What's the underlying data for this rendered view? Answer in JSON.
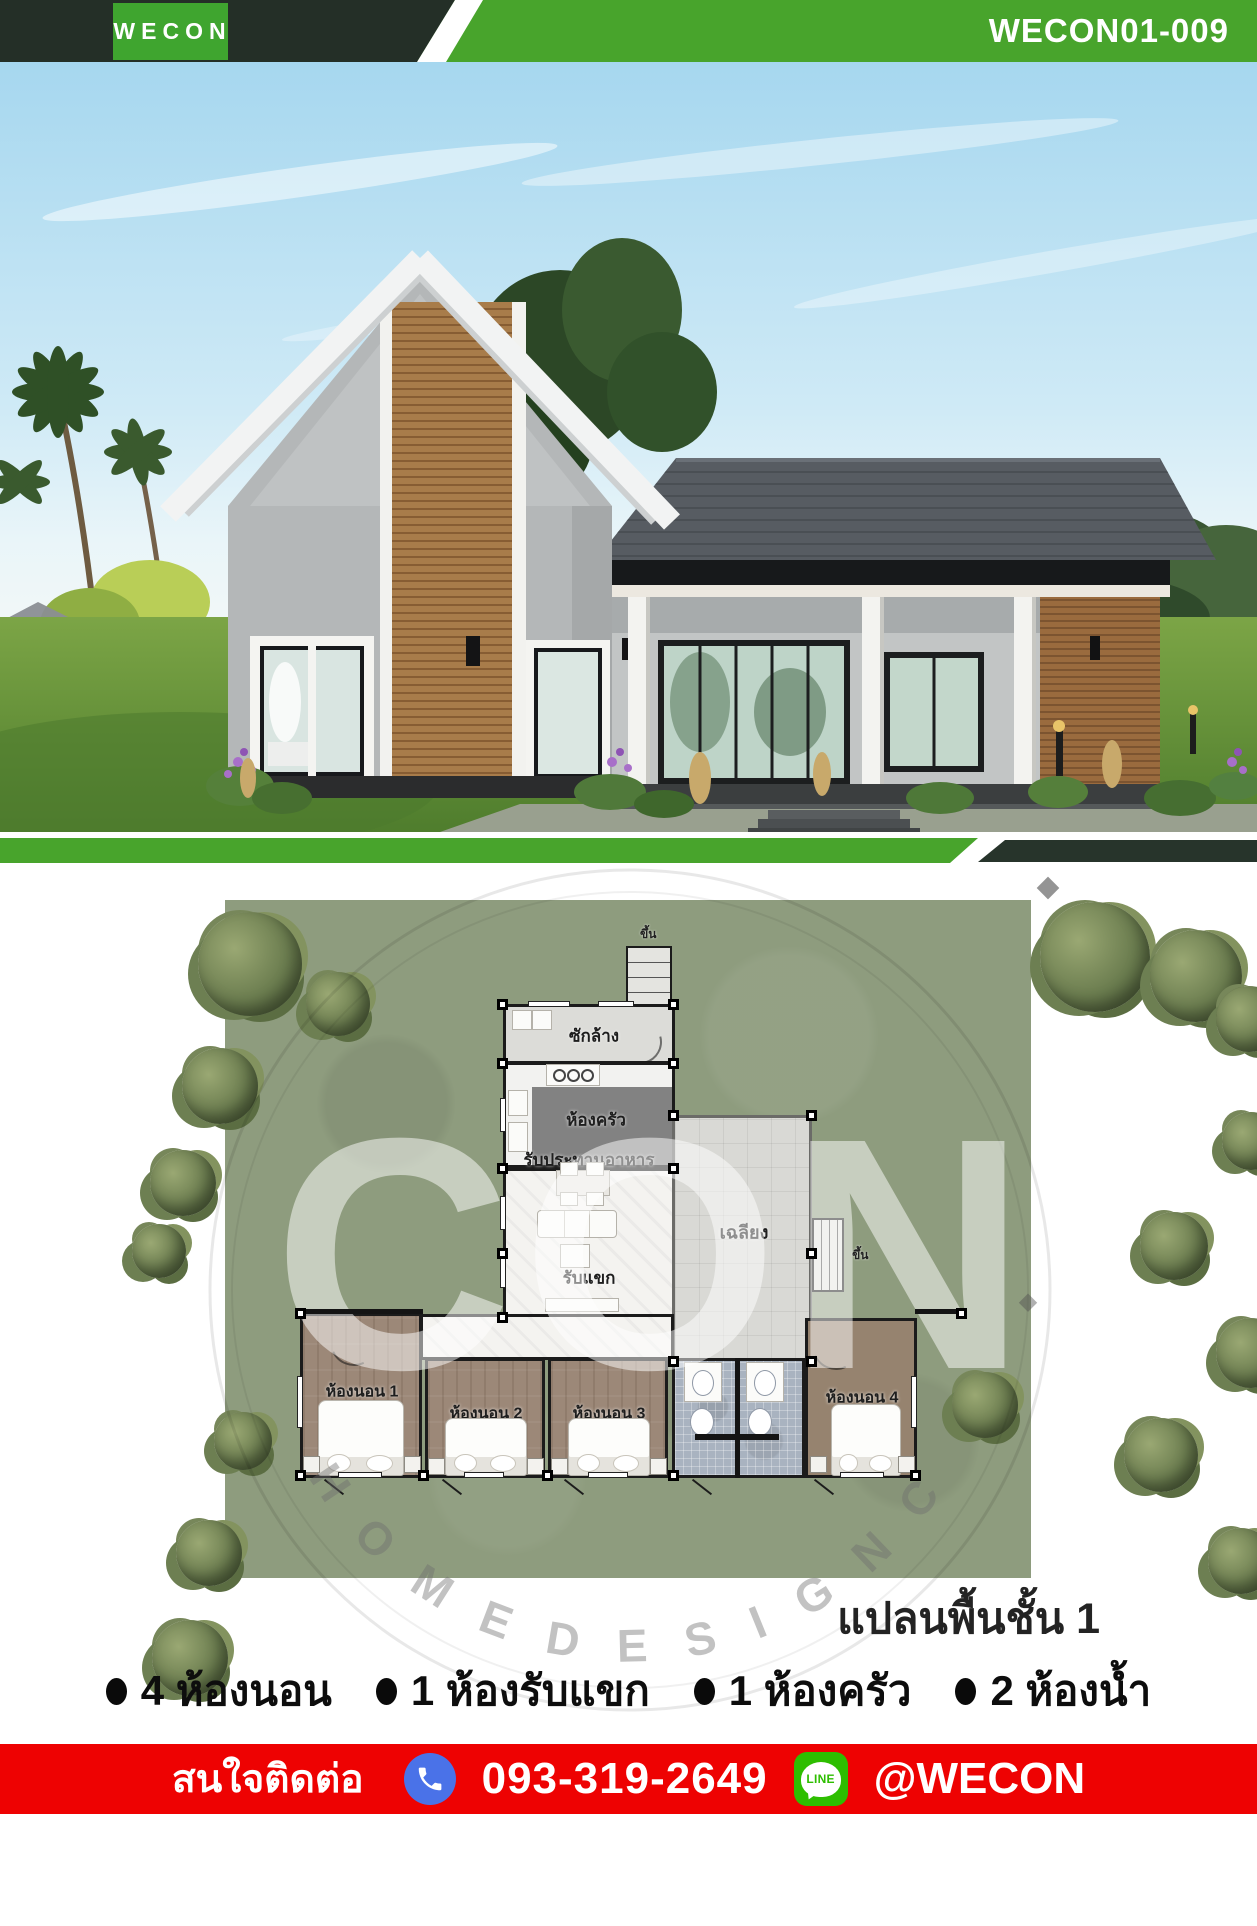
{
  "header": {
    "logo_text": "WECON",
    "project_code": "WECON01-009"
  },
  "plan": {
    "title": "แปลนพื้นชั้น 1",
    "rooms": {
      "laundry": "ซักล้าง",
      "kitchen": "ห้องครัว",
      "dining": "รับประทานอาหาร",
      "living": "รับแขก",
      "terrace": "เฉลียง",
      "bedroom1": "ห้องนอน 1",
      "bedroom2": "ห้องนอน 2",
      "bedroom3": "ห้องนอน 3",
      "bedroom4": "ห้องนอน 4",
      "stairs_up_top": "ขึ้น",
      "stairs_up_side": "ขึ้น"
    },
    "watermark": {
      "center": "CON",
      "arc": "H O M E   D E S I G N   C O"
    }
  },
  "features": [
    {
      "text": "4 ห้องนอน"
    },
    {
      "text": "1 ห้องรับแขก"
    },
    {
      "text": "1 ห้องครัว"
    },
    {
      "text": "2 ห้องน้ำ"
    }
  ],
  "contact": {
    "prompt": "สนใจติดต่อ",
    "phone": "093-319-2649",
    "line_label": "LINE",
    "line_id": "@WECON"
  },
  "colors": {
    "brand_green": "#48a42c",
    "dark_green": "#242f27",
    "contact_red": "#ee0202",
    "phone_blue": "#4a72e8",
    "line_green": "#2ebe00"
  }
}
